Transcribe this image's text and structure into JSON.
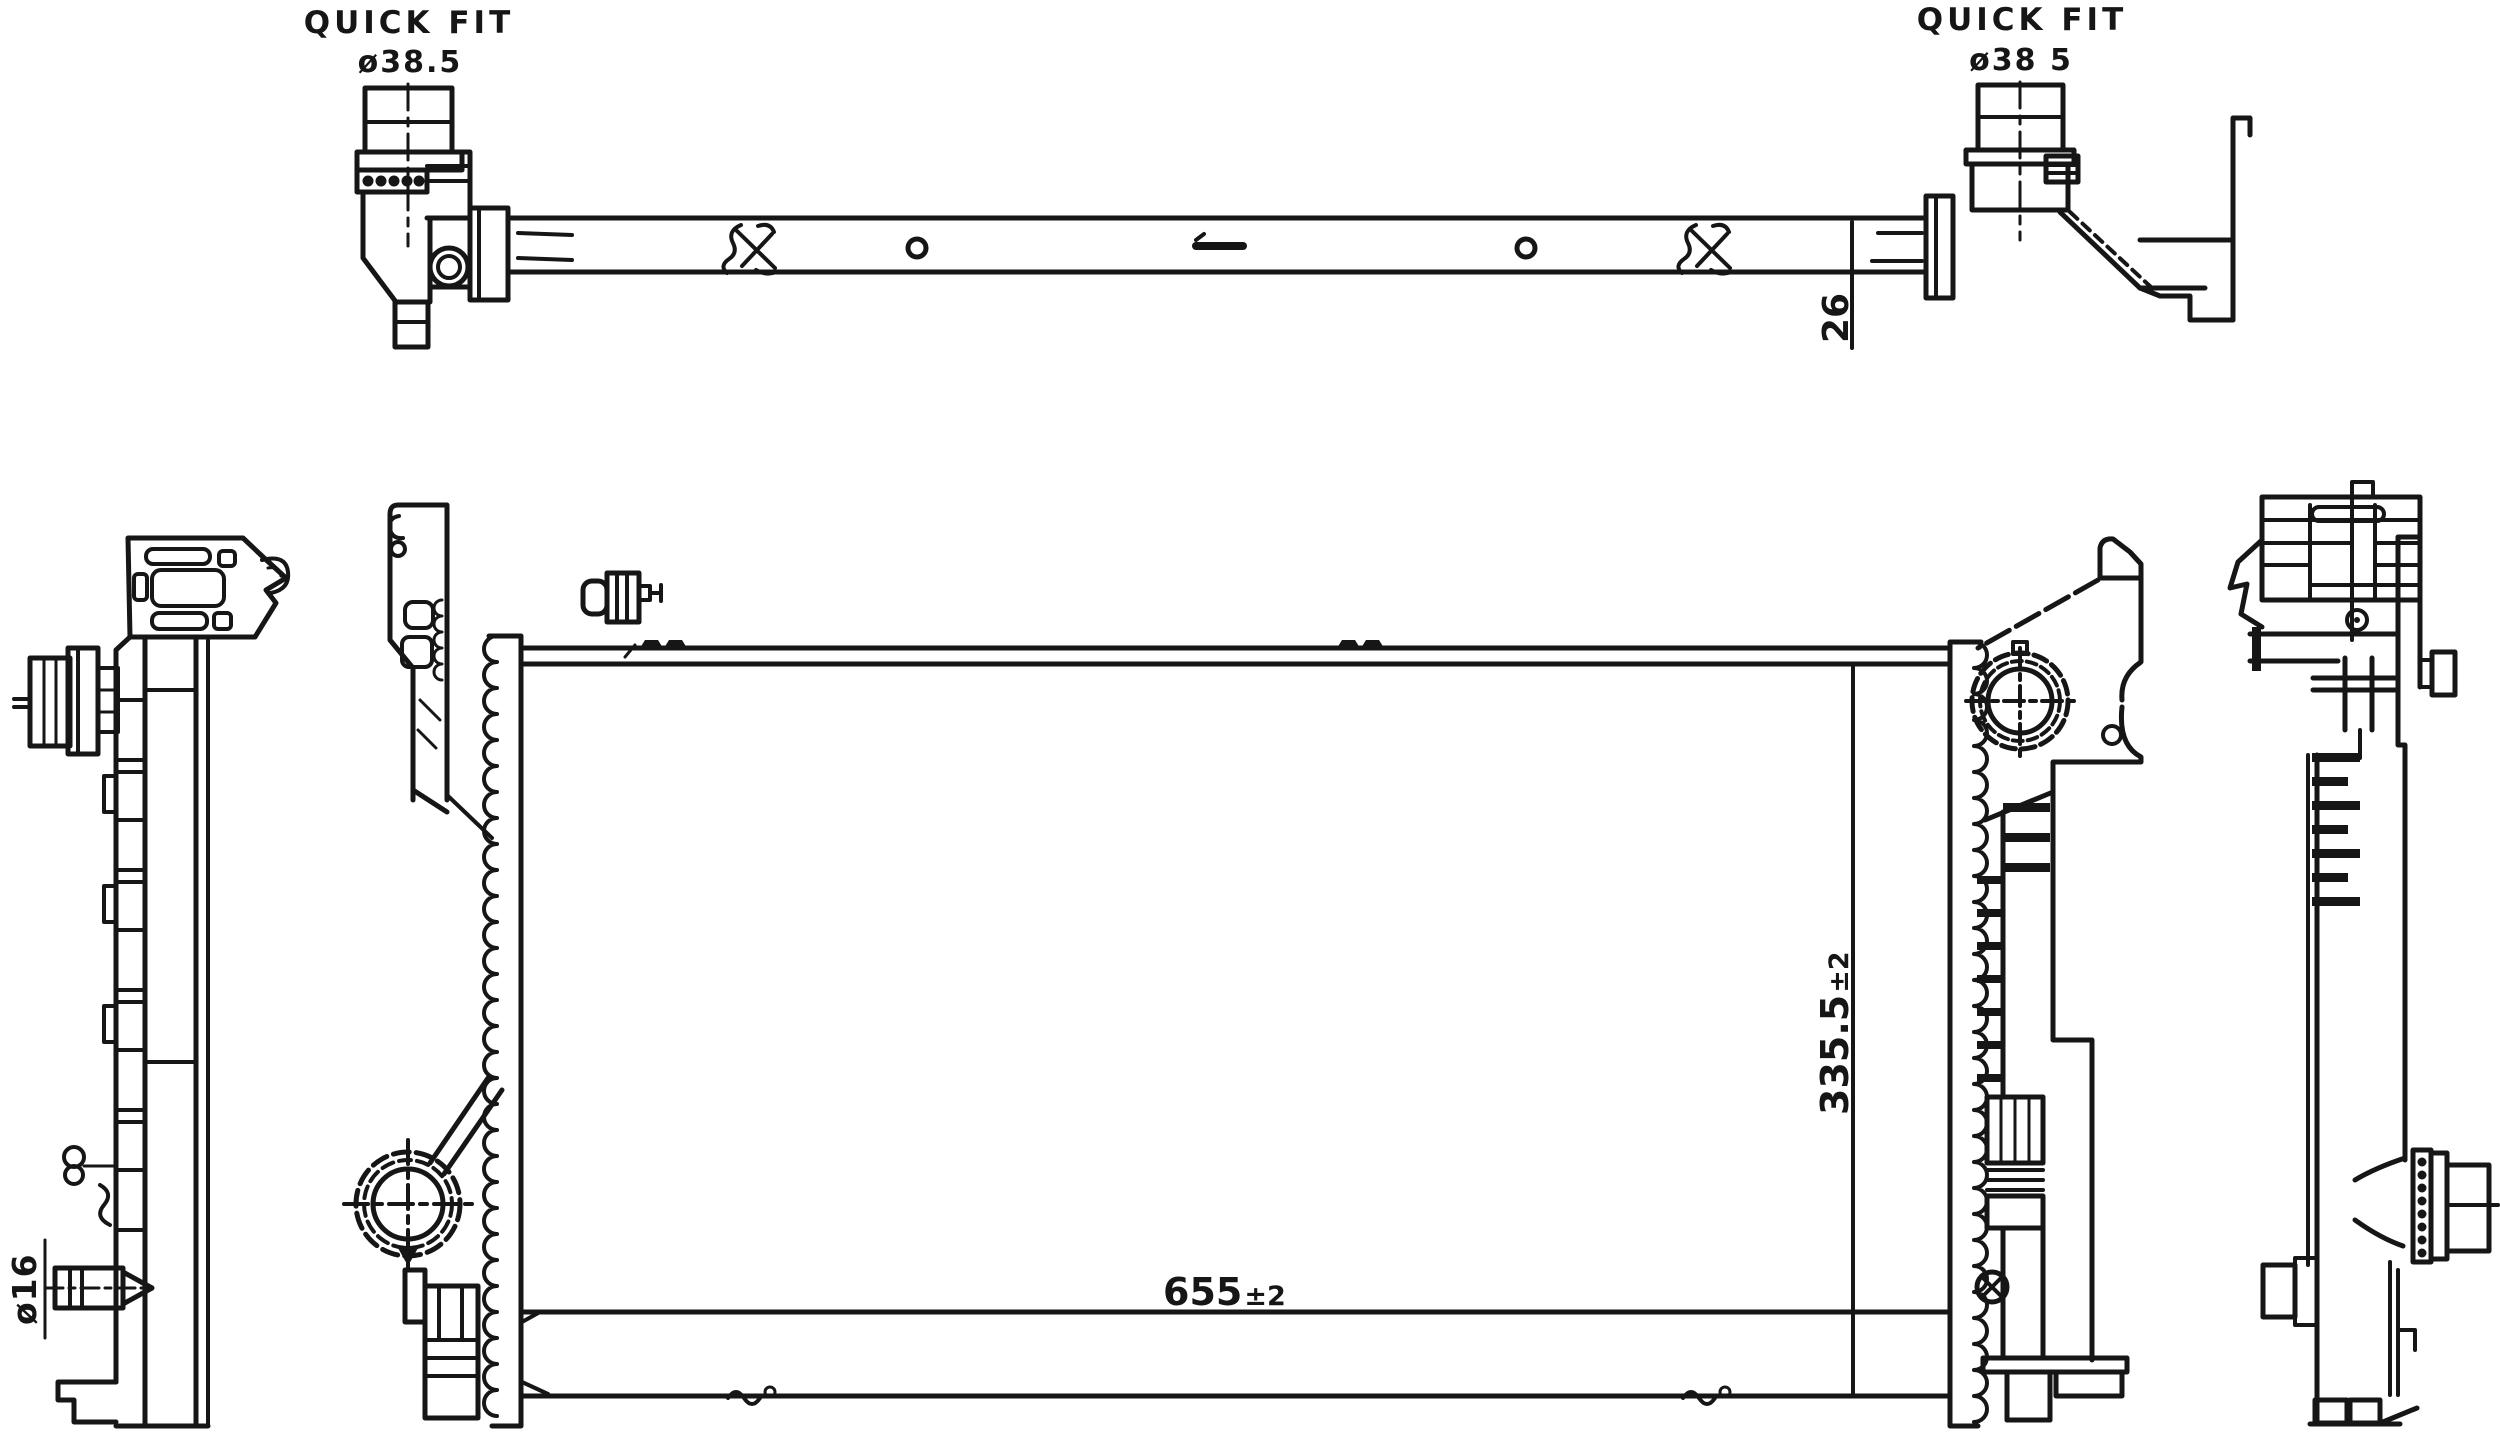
{
  "drawing": {
    "type": "technical-drawing",
    "subject": "Radiator multi-view engineering drawing",
    "colors": {
      "ink": "#161616",
      "background": "#ffffff"
    },
    "labels": {
      "quick_fit_left": {
        "title": "QUICK FIT",
        "diameter": "ø38.5"
      },
      "quick_fit_right": {
        "title": "QUICK FIT",
        "diameter": "ø38 5"
      },
      "bar_thickness": "26",
      "core_width": {
        "value": "655",
        "tolerance": "±2"
      },
      "core_height": {
        "value": "335.5",
        "tolerance": "±2"
      },
      "drain_outlet": "ø16"
    }
  }
}
